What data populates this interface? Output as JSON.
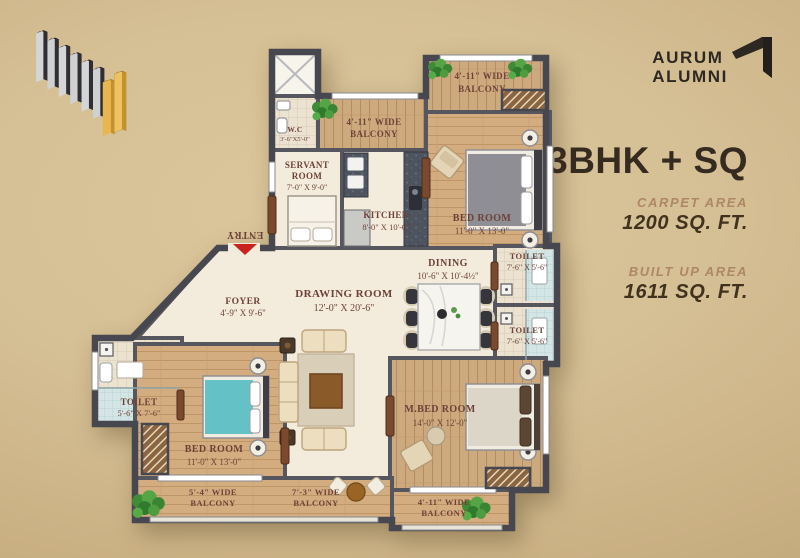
{
  "branding": {
    "logo_line1": "AURUM",
    "logo_line2": "ALUMNI"
  },
  "unit": {
    "title": "3BHK + SQ",
    "carpet_area_label": "CARPET AREA",
    "carpet_area_value": "1200 SQ. FT.",
    "built_up_area_label": "BUILT UP AREA",
    "built_up_area_value": "1611 SQ. FT."
  },
  "plan": {
    "labels": {
      "entry": "ENTRY",
      "wc_name": "W.C",
      "wc_dims": "3'-6\"X5'-0\"",
      "balc_tc_1": "4'-11\" WIDE",
      "balc_tc_2": "BALCONY",
      "servant_1": "SERVANT",
      "servant_2": "ROOM",
      "servant_dims": "7'-0\" X 9'-0\"",
      "kitchen_name": "KITCHEN",
      "kitchen_dims": "8'-0\" X 10'-0\"",
      "balc_tr_1": "4'-11\" WIDE",
      "balc_tr_2": "BALCONY",
      "bed_tr_name": "BED ROOM",
      "bed_tr_dims": "11'-0\" X 13'-0\"",
      "dining_name": "DINING",
      "dining_dims": "10'-6\" X 10'-4½\"",
      "toilet_r1_name": "TOILET",
      "toilet_r1_dims": "7'-6\" X 5'-6\"",
      "toilet_r2_name": "TOILET",
      "toilet_r2_dims": "7'-6\" X 5'-6\"",
      "drawing_name": "DRAWING ROOM",
      "drawing_dims": "12'-0\" X 20'-6\"",
      "foyer_name": "FOYER",
      "foyer_dims": "4'-9\" X 9'-6\"",
      "toilet_l_name": "TOILET",
      "toilet_l_dims": "5'-6\" X 7'-6\"",
      "bed_bl_name": "BED ROOM",
      "bed_bl_dims": "11'-0\" X 13'-0\"",
      "mbed_name": "M.BED ROOM",
      "mbed_dims": "14'-0\" X 12'-0\"",
      "balc_b1_1": "5'-4\" WIDE",
      "balc_b1_2": "BALCONY",
      "balc_b2_1": "7'-3\" WIDE",
      "balc_b2_2": "BALCONY",
      "balc_b3_1": "4'-11\" WIDE",
      "balc_b3_2": "BALCONY"
    }
  },
  "colors": {
    "background": "#d3bd92",
    "accent_gold": "#e4b450",
    "wall": "#55555c",
    "wood_floor": "#cfa97c",
    "plan_label": "#6e4238",
    "title_text": "#352b20",
    "area_label": "#ae8766",
    "entry_arrow": "#c8231c"
  }
}
